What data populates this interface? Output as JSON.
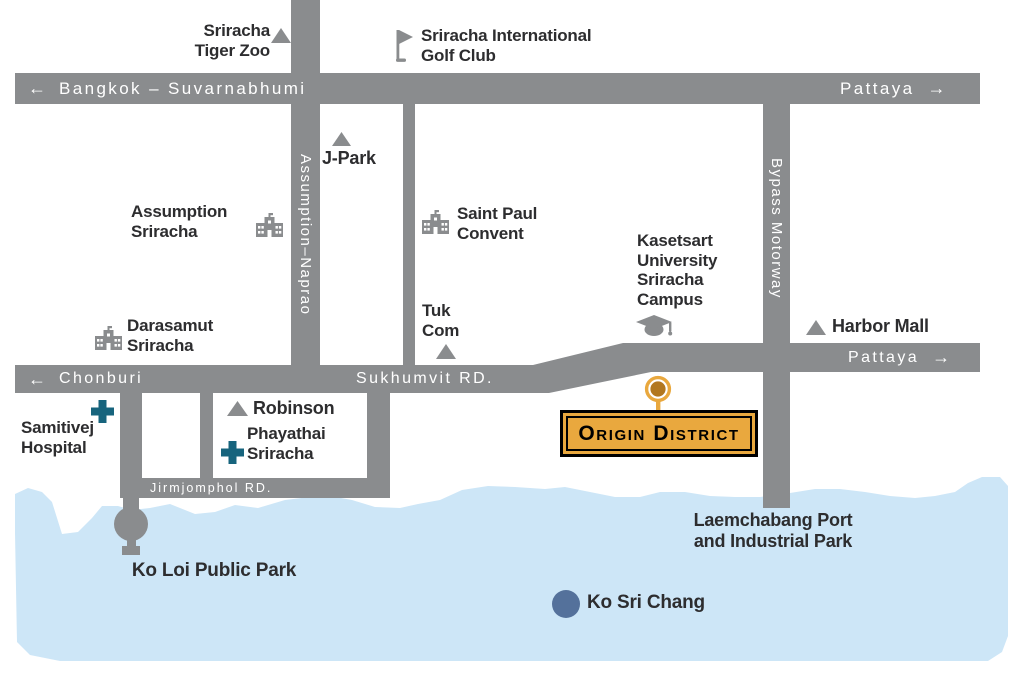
{
  "colors": {
    "road": "#8a8c8e",
    "water": "#cde6f7",
    "text_dark": "#2d2d2f",
    "hospital_teal": "#17647d",
    "island_blue": "#54719b",
    "sign_yellow": "#e9a83e",
    "pin_bronze": "#b2771f",
    "label_white": "#ffffff"
  },
  "icons": {
    "arrow_left": "←",
    "arrow_right": "→"
  },
  "roads": {
    "bangkok_suvarnabhumi": "Bangkok – Suvarnabhumi",
    "pattaya_top": "Pattaya",
    "chonburi": "Chonburi",
    "sukhumvit": "Sukhumvit RD.",
    "pattaya_mid": "Pattaya",
    "jirmjomphol": "Jirmjomphol RD.",
    "assumption_naprao": "Assumption–Naprao",
    "bypass_motorway": "Bypass Motorway"
  },
  "landmarks": {
    "tiger_zoo": {
      "label": "Sriracha\nTiger Zoo"
    },
    "golf_club": {
      "label": "Sriracha International\nGolf Club"
    },
    "j_park": {
      "label": "J-Park"
    },
    "assumption_school": {
      "label": "Assumption\nSriracha"
    },
    "saint_paul": {
      "label": "Saint Paul\nConvent"
    },
    "kasetsart": {
      "label": "Kasetsart\nUniversity\nSriracha\nCampus"
    },
    "harbor_mall": {
      "label": "Harbor Mall"
    },
    "darasamut": {
      "label": "Darasamut\nSriracha"
    },
    "tuk_com": {
      "label": "Tuk\nCom"
    },
    "robinson": {
      "label": "Robinson"
    },
    "phayathai": {
      "label": "Phayathai\nSriracha"
    },
    "samitivej": {
      "label": "Samitivej\nHospital"
    },
    "ko_loi": {
      "label": "Ko Loi Public Park"
    },
    "laemchabang": {
      "label": "Laemchabang Port\nand Industrial Park"
    },
    "ko_sri_chang": {
      "label": "Ko Sri Chang"
    }
  },
  "sign": {
    "label": "Origin District"
  }
}
